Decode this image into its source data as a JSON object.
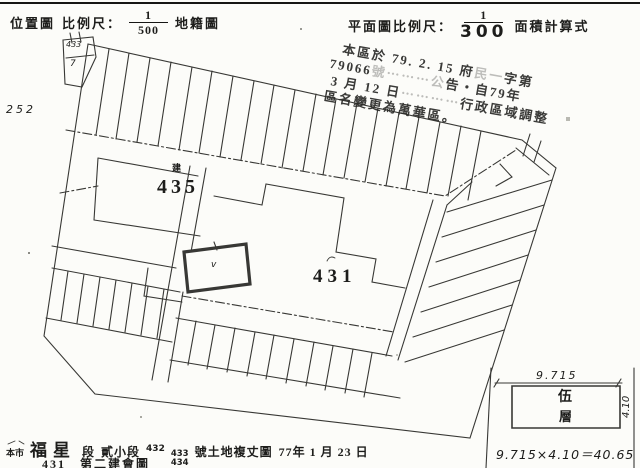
{
  "header": {
    "left": {
      "title": "位置圖",
      "scale_label": "比例尺：",
      "numerator": "1",
      "denominator": "500",
      "suffix": "地籍圖"
    },
    "right": {
      "scale_label": "平面圖比例尺：",
      "numerator": "1",
      "denominator": "300",
      "suffix": "面積計算式"
    }
  },
  "stamp": {
    "lines": [
      {
        "pre": "本區於 79. 2. 15 府",
        "faint": "民一",
        "post": "字第"
      },
      {
        "pre": "79066",
        "faint": "號⋯⋯⋯公",
        "post": "告・自79年"
      },
      {
        "pre": "3 月 12 日",
        "faint": "⋯⋯⋯⋯",
        "post": "行政區域調整"
      },
      {
        "pre": "區名變更為萬華區。",
        "faint": "",
        "post": ""
      }
    ]
  },
  "map_labels": {
    "margin_number": "252",
    "corner_parcel_top": "433",
    "corner_parcel_bottom": "7",
    "parcel435_prefix": "建",
    "parcel435": "435",
    "parcel431": "431",
    "subject_mark": "v"
  },
  "floor_plan": {
    "width": "9.715",
    "height": "4.10",
    "label_top": "伍",
    "label_bottom": "層",
    "calculation": "9.715×4.10＝40.65"
  },
  "caption": {
    "prefix": "本市",
    "section": "福星",
    "section_suffix": "段",
    "subsection": "貳小段",
    "lot_first": "432",
    "lot_top": "433",
    "lot_bottom": "434",
    "suffix": "號土地複丈圖",
    "date": "77年 1 月 23 日",
    "second_line": "431　第二建會圖"
  }
}
